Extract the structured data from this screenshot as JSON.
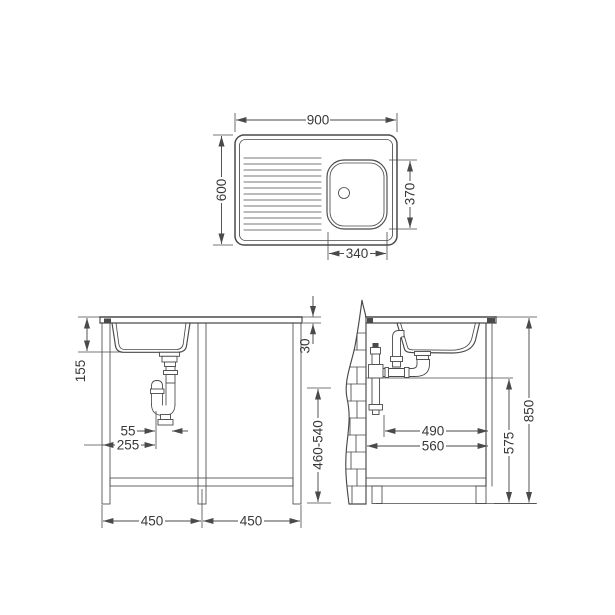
{
  "page": {
    "background": "#ffffff",
    "line_color": "#4a4a4a",
    "text_color": "#383838"
  },
  "top_view": {
    "overall_width": "900",
    "overall_depth": "600",
    "bowl_depth": "370",
    "bowl_width": "340"
  },
  "front_view": {
    "bowl_height": "155",
    "trap_offset": "55",
    "trap_from_left": "255",
    "worktop_thickness": "30",
    "left_unit_width": "450",
    "right_unit_width": "450"
  },
  "side_view": {
    "outlet_height_range": "460-540",
    "clear_depth": "490",
    "unit_depth": "560",
    "front_height": "575",
    "worktop_height": "850"
  }
}
